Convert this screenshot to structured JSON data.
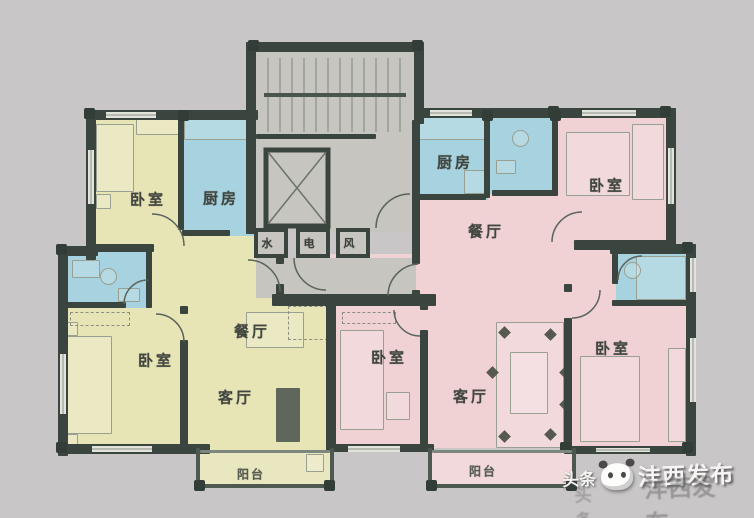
{
  "colors": {
    "background": "#c9c6c7",
    "walls": "#3a4540",
    "left_apartment_fill": "#e7e4b6",
    "right_apartment_fill": "#f0d2d5",
    "wet_room_fill": "#a7d2df",
    "core_fill": "#c6c5bf",
    "label_text": "#40453e"
  },
  "core": {
    "shafts": [
      {
        "id": "water-shaft",
        "label": "水"
      },
      {
        "id": "electric-shaft",
        "label": "电"
      },
      {
        "id": "air-shaft",
        "label": "风"
      }
    ]
  },
  "left_apartment": {
    "rooms": [
      {
        "id": "bedroom-top",
        "label": "卧室"
      },
      {
        "id": "kitchen",
        "label": "厨房"
      },
      {
        "id": "dining",
        "label": "餐厅"
      },
      {
        "id": "bedroom-lower",
        "label": "卧室"
      },
      {
        "id": "living",
        "label": "客厅"
      },
      {
        "id": "balcony",
        "label": "阳台"
      }
    ]
  },
  "right_apartment": {
    "rooms": [
      {
        "id": "kitchen",
        "label": "厨房"
      },
      {
        "id": "dining",
        "label": "餐厅"
      },
      {
        "id": "bedroom-northeast",
        "label": "卧室"
      },
      {
        "id": "bedroom-middle",
        "label": "卧室"
      },
      {
        "id": "living",
        "label": "客厅"
      },
      {
        "id": "bedroom-southeast",
        "label": "卧室"
      },
      {
        "id": "balcony",
        "label": "阳台"
      }
    ]
  },
  "watermark": {
    "prefix": "头条",
    "account": "沣西发布"
  }
}
